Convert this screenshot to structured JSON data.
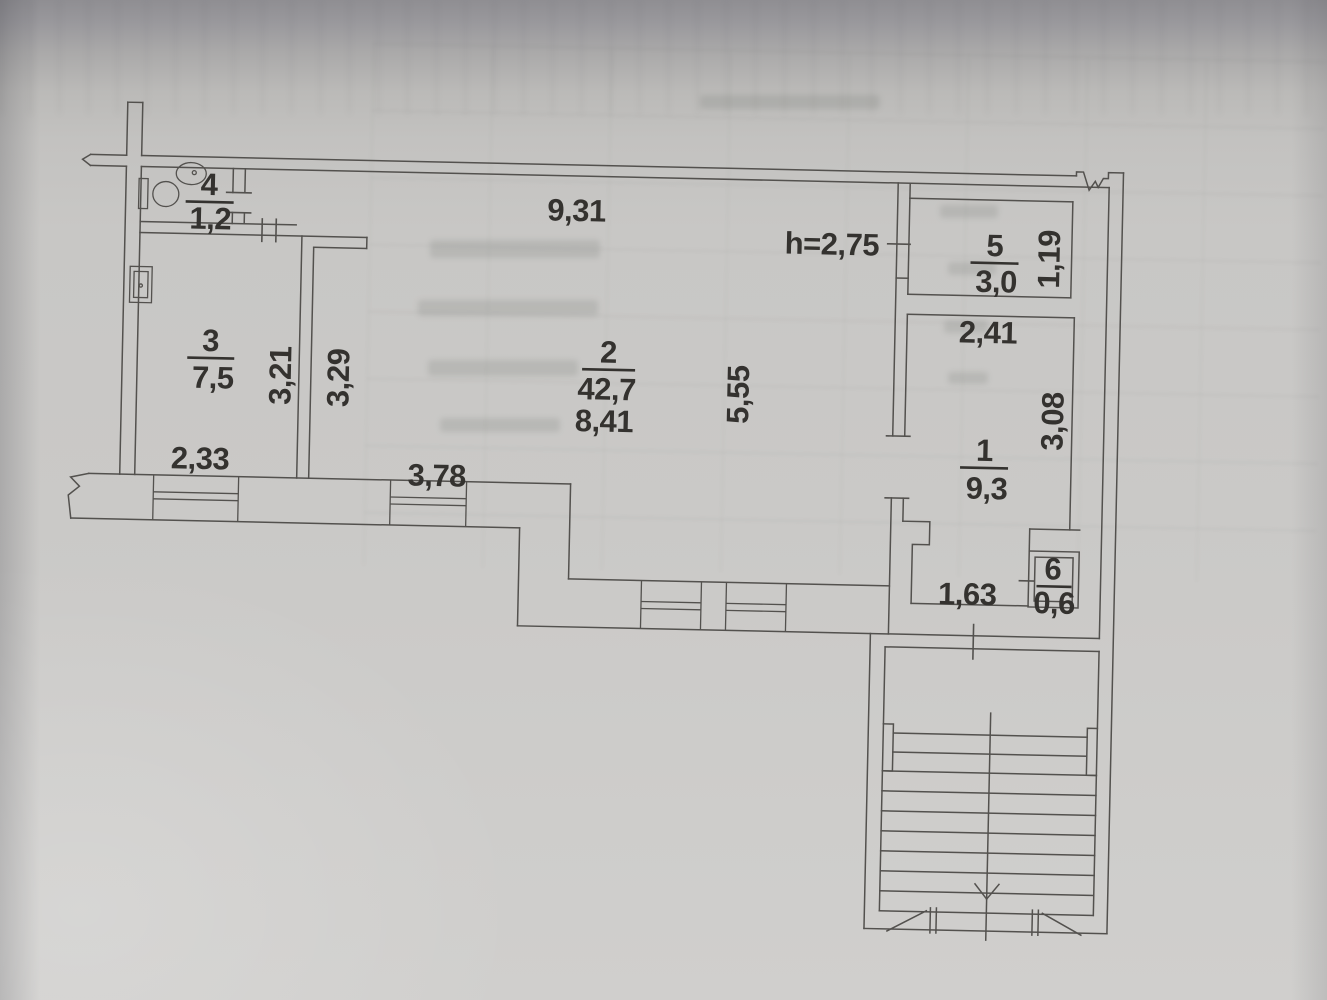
{
  "colors": {
    "paper": "#c8c7c5",
    "paper_top": "#8f8e92",
    "line": "#53514e",
    "ink": "#34322f"
  },
  "plan": {
    "ceiling_height_label": "h=2,75",
    "rooms": {
      "r1": {
        "number": "1",
        "area": "9,3"
      },
      "r2": {
        "number": "2",
        "area": "42,7",
        "width_label": "8,41"
      },
      "r3": {
        "number": "3",
        "area": "7,5"
      },
      "r4": {
        "number": "4",
        "area": "1,2"
      },
      "r5": {
        "number": "5",
        "area": "3,0"
      },
      "r6": {
        "number": "6",
        "area": "0,6"
      }
    },
    "dimensions": {
      "top_width": "9,31",
      "room3_width": "2,33",
      "room3_height": "3,21",
      "hall_left_height": "3,29",
      "hall_bottom_width": "3,78",
      "hall_right_height": "5,55",
      "room1_width": "2,41",
      "room1_height": "3,08",
      "room5_height": "1,19",
      "entry_width": "1,63"
    }
  }
}
